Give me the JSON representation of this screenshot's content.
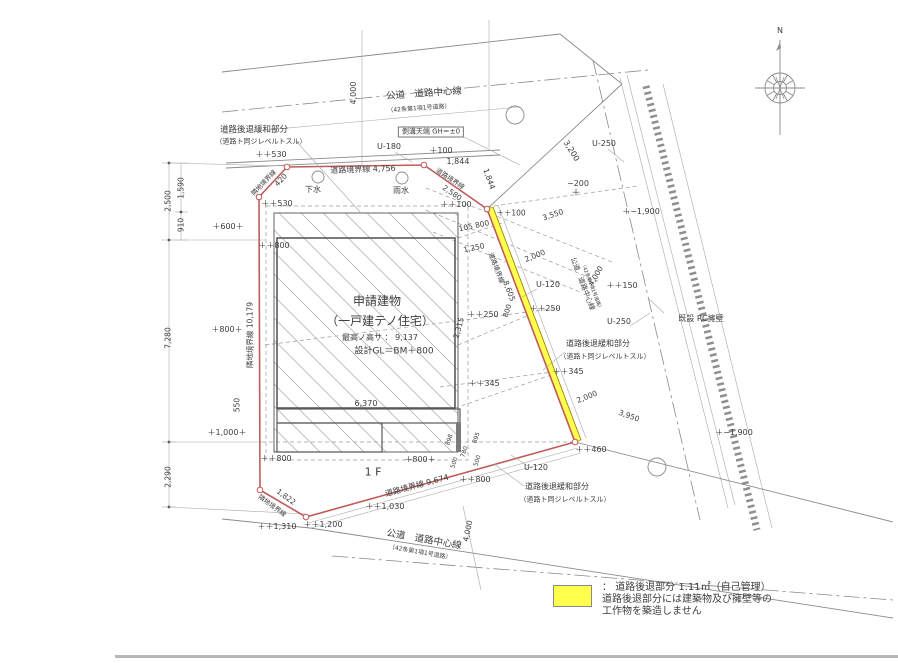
{
  "legend": {
    "colon": "： ",
    "line1": "道路後退部分 1.11㎡（自己管理）",
    "line2": "道路後退部分には建築物及び擁壁等の",
    "line3": "工作物を築造しません",
    "swatch_color": "#ffff4d"
  },
  "colors": {
    "boundary_red": "#c05a5a",
    "setback_yellow": "#ffff4d",
    "line_gray": "#8a8a8a"
  },
  "labels": [
    {
      "t": "公道　道路中心線",
      "x": 424,
      "y": 94,
      "r": -4,
      "s": 9.5
    },
    {
      "t": "（42条第1項1号道路）",
      "x": 419,
      "y": 109,
      "r": -4,
      "s": 6
    },
    {
      "t": "側溝天端 GH＝±0",
      "x": 431,
      "y": 132,
      "s": 7,
      "box": true
    },
    {
      "t": "4,000",
      "x": 354,
      "y": 93,
      "r": -90,
      "s": 8
    },
    {
      "t": "道路後退緩和部分",
      "x": 254,
      "y": 130,
      "s": 8.5
    },
    {
      "t": "（道路ト同ジレベルトスル）",
      "x": 261,
      "y": 142,
      "s": 7
    },
    {
      "t": "U-180",
      "x": 389,
      "y": 147,
      "s": 8
    },
    {
      "t": "＋100",
      "x": 441,
      "y": 151,
      "s": 8
    },
    {
      "t": "1,844",
      "x": 458,
      "y": 162,
      "s": 8
    },
    {
      "t": "道路境界線 4,756",
      "x": 363,
      "y": 170,
      "r": -2,
      "s": 8
    },
    {
      "t": "＋＋530",
      "x": 271,
      "y": 155,
      "s": 8
    },
    {
      "t": "＋＋530",
      "x": 277,
      "y": 204,
      "s": 8
    },
    {
      "t": "下水",
      "x": 313,
      "y": 190,
      "s": 8
    },
    {
      "t": "雨水",
      "x": 401,
      "y": 191,
      "s": 8
    },
    {
      "t": "＋＋100",
      "x": 456,
      "y": 205,
      "s": 8
    },
    {
      "t": "隣地境界線",
      "x": 264,
      "y": 183,
      "r": -46,
      "s": 6.5
    },
    {
      "t": "420",
      "x": 281,
      "y": 180,
      "r": -46,
      "s": 7.5
    },
    {
      "t": "道路境界線",
      "x": 450,
      "y": 179,
      "r": 34,
      "s": 6.5
    },
    {
      "t": "2,580",
      "x": 452,
      "y": 193,
      "r": 34,
      "s": 7.5
    },
    {
      "t": "1,844",
      "x": 489,
      "y": 179,
      "r": 70,
      "s": 7.5
    },
    {
      "t": "3,200",
      "x": 571,
      "y": 151,
      "r": 58,
      "s": 8
    },
    {
      "t": "U-250",
      "x": 604,
      "y": 144,
      "s": 8
    },
    {
      "t": "−200",
      "x": 578,
      "y": 184,
      "s": 8
    },
    {
      "t": "＋",
      "x": 576,
      "y": 194,
      "s": 9
    },
    {
      "t": "＋−1,900",
      "x": 641,
      "y": 212,
      "s": 8
    },
    {
      "t": "＋−1,900",
      "x": 734,
      "y": 433,
      "s": 8
    },
    {
      "t": "既設 RC擁壁",
      "x": 701,
      "y": 319,
      "s": 8
    },
    {
      "t": "U-250",
      "x": 619,
      "y": 322,
      "s": 8
    },
    {
      "t": "105 800",
      "x": 474,
      "y": 226,
      "r": -12,
      "s": 7.5
    },
    {
      "t": "1,250",
      "x": 474,
      "y": 248,
      "r": -12,
      "s": 7.5
    },
    {
      "t": "＋＋100",
      "x": 511,
      "y": 213,
      "s": 7.5
    },
    {
      "t": "3,550",
      "x": 553,
      "y": 215,
      "r": -18,
      "s": 7.5
    },
    {
      "t": "2,000",
      "x": 535,
      "y": 256,
      "r": -22,
      "s": 7.5
    },
    {
      "t": "U-120",
      "x": 548,
      "y": 285,
      "s": 8
    },
    {
      "t": "＋＋250",
      "x": 483,
      "y": 315,
      "s": 8
    },
    {
      "t": "800",
      "x": 508,
      "y": 311,
      "r": -72,
      "s": 7
    },
    {
      "t": "＋＋250",
      "x": 545,
      "y": 309,
      "s": 8
    },
    {
      "t": "2,315",
      "x": 459,
      "y": 328,
      "r": -74,
      "s": 7.5
    },
    {
      "t": "道路境界線",
      "x": 496,
      "y": 268,
      "r": 69,
      "s": 6.5
    },
    {
      "t": "8,605",
      "x": 509,
      "y": 291,
      "r": 69,
      "s": 7.5
    },
    {
      "t": "公道　道路中心線",
      "x": 582,
      "y": 284,
      "r": 69,
      "s": 7
    },
    {
      "t": "（42条第1項1号道路）",
      "x": 590,
      "y": 287,
      "r": 69,
      "s": 4.8
    },
    {
      "t": "4,000",
      "x": 596,
      "y": 276,
      "r": -60,
      "s": 7.5
    },
    {
      "t": "＋＋150",
      "x": 622,
      "y": 286,
      "s": 8
    },
    {
      "t": "道路後退緩和部分",
      "x": 598,
      "y": 344,
      "s": 8
    },
    {
      "t": "（道路ト同ジレベルトスル）",
      "x": 605,
      "y": 357,
      "s": 7
    },
    {
      "t": "＋＋345",
      "x": 568,
      "y": 372,
      "s": 8
    },
    {
      "t": "＋＋345",
      "x": 484,
      "y": 384,
      "s": 8
    },
    {
      "t": "2,000",
      "x": 587,
      "y": 397,
      "r": -22,
      "s": 7.5
    },
    {
      "t": "3,950",
      "x": 629,
      "y": 416,
      "r": 20,
      "s": 7.5
    },
    {
      "t": "＋＋460",
      "x": 591,
      "y": 450,
      "s": 8
    },
    {
      "t": "U-120",
      "x": 536,
      "y": 468,
      "s": 8
    },
    {
      "t": "道路後退緩和部分",
      "x": 557,
      "y": 487,
      "s": 8
    },
    {
      "t": "（道路ト同ジレベルトスル）",
      "x": 565,
      "y": 500,
      "s": 7
    },
    {
      "t": "898",
      "x": 450,
      "y": 440,
      "r": -72,
      "s": 6
    },
    {
      "t": "895",
      "x": 477,
      "y": 438,
      "r": -72,
      "s": 6
    },
    {
      "t": "780",
      "x": 465,
      "y": 452,
      "r": -72,
      "s": 6
    },
    {
      "t": "500",
      "x": 455,
      "y": 463,
      "r": -72,
      "s": 6
    },
    {
      "t": "500",
      "x": 478,
      "y": 461,
      "r": -72,
      "s": 6
    },
    {
      "t": "申請建物",
      "x": 377,
      "y": 301,
      "s": 12
    },
    {
      "t": "（一戸建テノ住宅）",
      "x": 380,
      "y": 321,
      "s": 12
    },
    {
      "t": "最高ノ高サ ： 9,137",
      "x": 380,
      "y": 338,
      "s": 8
    },
    {
      "t": "設計GL＝BM＋800",
      "x": 394,
      "y": 352,
      "s": 9
    },
    {
      "t": "1 F",
      "x": 373,
      "y": 472,
      "s": 11
    },
    {
      "t": "6,370",
      "x": 366,
      "y": 404,
      "s": 8
    },
    {
      "t": "550",
      "x": 237,
      "y": 405,
      "r": -90,
      "s": 7.5
    },
    {
      "t": "＋＋800",
      "x": 274,
      "y": 246,
      "s": 8
    },
    {
      "t": "＋＋800",
      "x": 276,
      "y": 459,
      "s": 8
    },
    {
      "t": "＋800＋",
      "x": 420,
      "y": 460,
      "s": 8
    },
    {
      "t": "＋＋800",
      "x": 475,
      "y": 480,
      "s": 8
    },
    {
      "t": "＋600＋",
      "x": 228,
      "y": 227,
      "s": 8
    },
    {
      "t": "＋800＋",
      "x": 227,
      "y": 330,
      "s": 8
    },
    {
      "t": "＋1,000＋",
      "x": 227,
      "y": 433,
      "s": 8
    },
    {
      "t": "隣地境界線 10,179",
      "x": 250,
      "y": 335,
      "r": -90,
      "s": 7.5
    },
    {
      "t": "2,500",
      "x": 168,
      "y": 201,
      "r": -90,
      "s": 7.5
    },
    {
      "t": "1,590",
      "x": 181,
      "y": 188,
      "r": -90,
      "s": 7.5
    },
    {
      "t": "910",
      "x": 181,
      "y": 225,
      "r": -90,
      "s": 7.5
    },
    {
      "t": "7,280",
      "x": 168,
      "y": 338,
      "r": -90,
      "s": 7.5
    },
    {
      "t": "2,290",
      "x": 168,
      "y": 477,
      "r": -90,
      "s": 7.5
    },
    {
      "t": "道路境界線 9,674",
      "x": 417,
      "y": 486,
      "r": -15,
      "s": 8
    },
    {
      "t": "＋＋1,030",
      "x": 385,
      "y": 507,
      "s": 8
    },
    {
      "t": "1,822",
      "x": 286,
      "y": 497,
      "r": 36,
      "s": 7.5
    },
    {
      "t": "隣地境界線",
      "x": 272,
      "y": 506,
      "r": 36,
      "s": 6.5
    },
    {
      "t": "＋＋1,310",
      "x": 277,
      "y": 527,
      "s": 8
    },
    {
      "t": "＋＋1,200",
      "x": 323,
      "y": 525,
      "s": 8
    },
    {
      "t": "公道　道路中心線",
      "x": 424,
      "y": 540,
      "r": 10,
      "s": 9.5
    },
    {
      "t": "（42条第1項1号道路）",
      "x": 420,
      "y": 553,
      "r": 10,
      "s": 6
    },
    {
      "t": "4,000",
      "x": 468,
      "y": 531,
      "r": -78,
      "s": 7.5
    },
    {
      "t": "N",
      "x": 780,
      "y": 31,
      "s": 8
    }
  ]
}
